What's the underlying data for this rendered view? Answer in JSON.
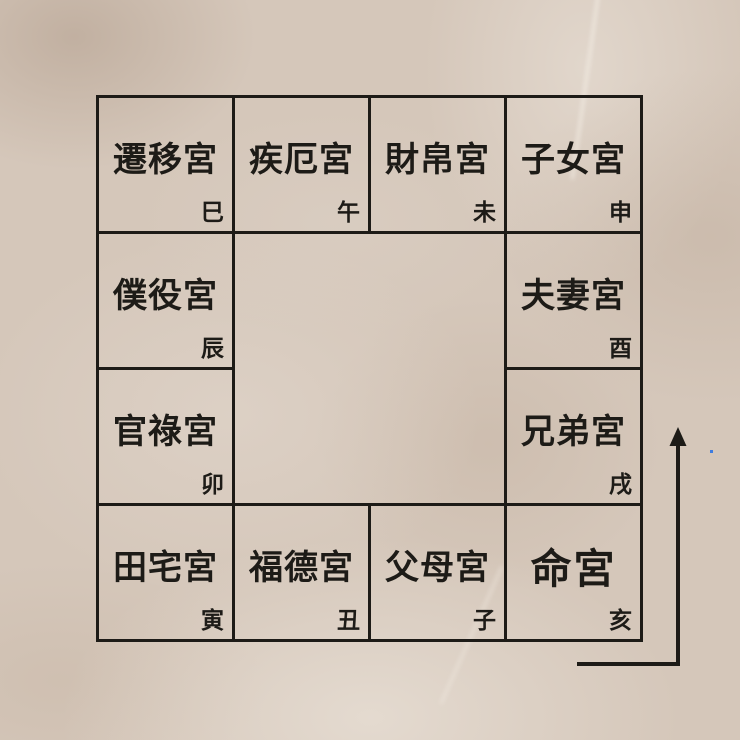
{
  "palette": {
    "background": "#d5c7ba",
    "line_color": "#1d1b17",
    "text_color": "#1d1b17",
    "accent_dot_color": "#3e7ce0"
  },
  "grid": {
    "name": "ziwei-twelve-palaces",
    "cells": [
      {
        "id": "si",
        "palace": "遷移宮",
        "branch": "巳",
        "row": 0,
        "col": 0
      },
      {
        "id": "wu",
        "palace": "疾厄宮",
        "branch": "午",
        "row": 0,
        "col": 1
      },
      {
        "id": "wei",
        "palace": "財帛宮",
        "branch": "未",
        "row": 0,
        "col": 2
      },
      {
        "id": "shen",
        "palace": "子女宮",
        "branch": "申",
        "row": 0,
        "col": 3
      },
      {
        "id": "chen",
        "palace": "僕役宮",
        "branch": "辰",
        "row": 1,
        "col": 0
      },
      {
        "id": "you",
        "palace": "夫妻宮",
        "branch": "酉",
        "row": 1,
        "col": 3
      },
      {
        "id": "mao",
        "palace": "官祿宮",
        "branch": "卯",
        "row": 2,
        "col": 0
      },
      {
        "id": "xu",
        "palace": "兄弟宮",
        "branch": "戌",
        "row": 2,
        "col": 3
      },
      {
        "id": "yin",
        "palace": "田宅宮",
        "branch": "寅",
        "row": 3,
        "col": 0
      },
      {
        "id": "chou",
        "palace": "福德宮",
        "branch": "丑",
        "row": 3,
        "col": 1
      },
      {
        "id": "zi",
        "palace": "父母宮",
        "branch": "子",
        "row": 3,
        "col": 2
      },
      {
        "id": "hai",
        "palace": "命宮",
        "branch": "亥",
        "row": 3,
        "col": 3,
        "emphasis": true
      }
    ]
  },
  "icons": {
    "flow_arrow": "up-arrow"
  }
}
